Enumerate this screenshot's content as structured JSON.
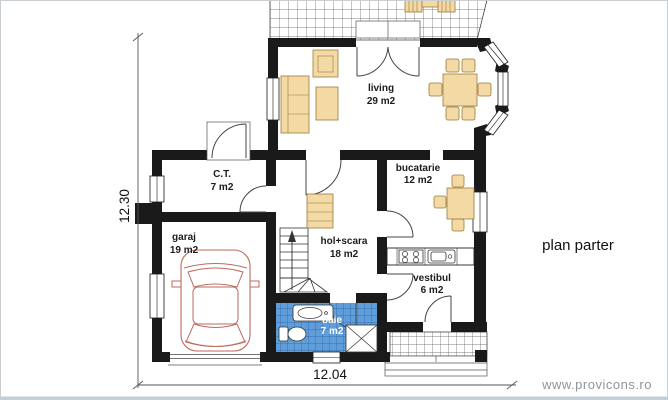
{
  "title": "plan parter",
  "watermark": "www.provicons.ro",
  "dimensions": {
    "width": "12.04",
    "height": "12.30"
  },
  "rooms": {
    "ct": {
      "name": "C.T.",
      "area": "7 m2"
    },
    "garaj": {
      "name": "garaj",
      "area": "19 m2"
    },
    "living": {
      "name": "living",
      "area": "29 m2"
    },
    "bucatarie": {
      "name": "bucatarie",
      "area": "12 m2"
    },
    "hol": {
      "name": "hol+scara",
      "area": "18 m2"
    },
    "vestibul": {
      "name": "vestibul",
      "area": "6 m2"
    },
    "baie": {
      "name": "baie",
      "area": "7 m2"
    }
  },
  "colors": {
    "wall": "#1a1a1a",
    "furniture": "#f3d9a4",
    "furniture_outline": "#9c7a3a",
    "tile": "#5f9ed8",
    "tile_line": "#2a5fa8",
    "car": "#c06a5e",
    "watermark": "#8f959b"
  }
}
